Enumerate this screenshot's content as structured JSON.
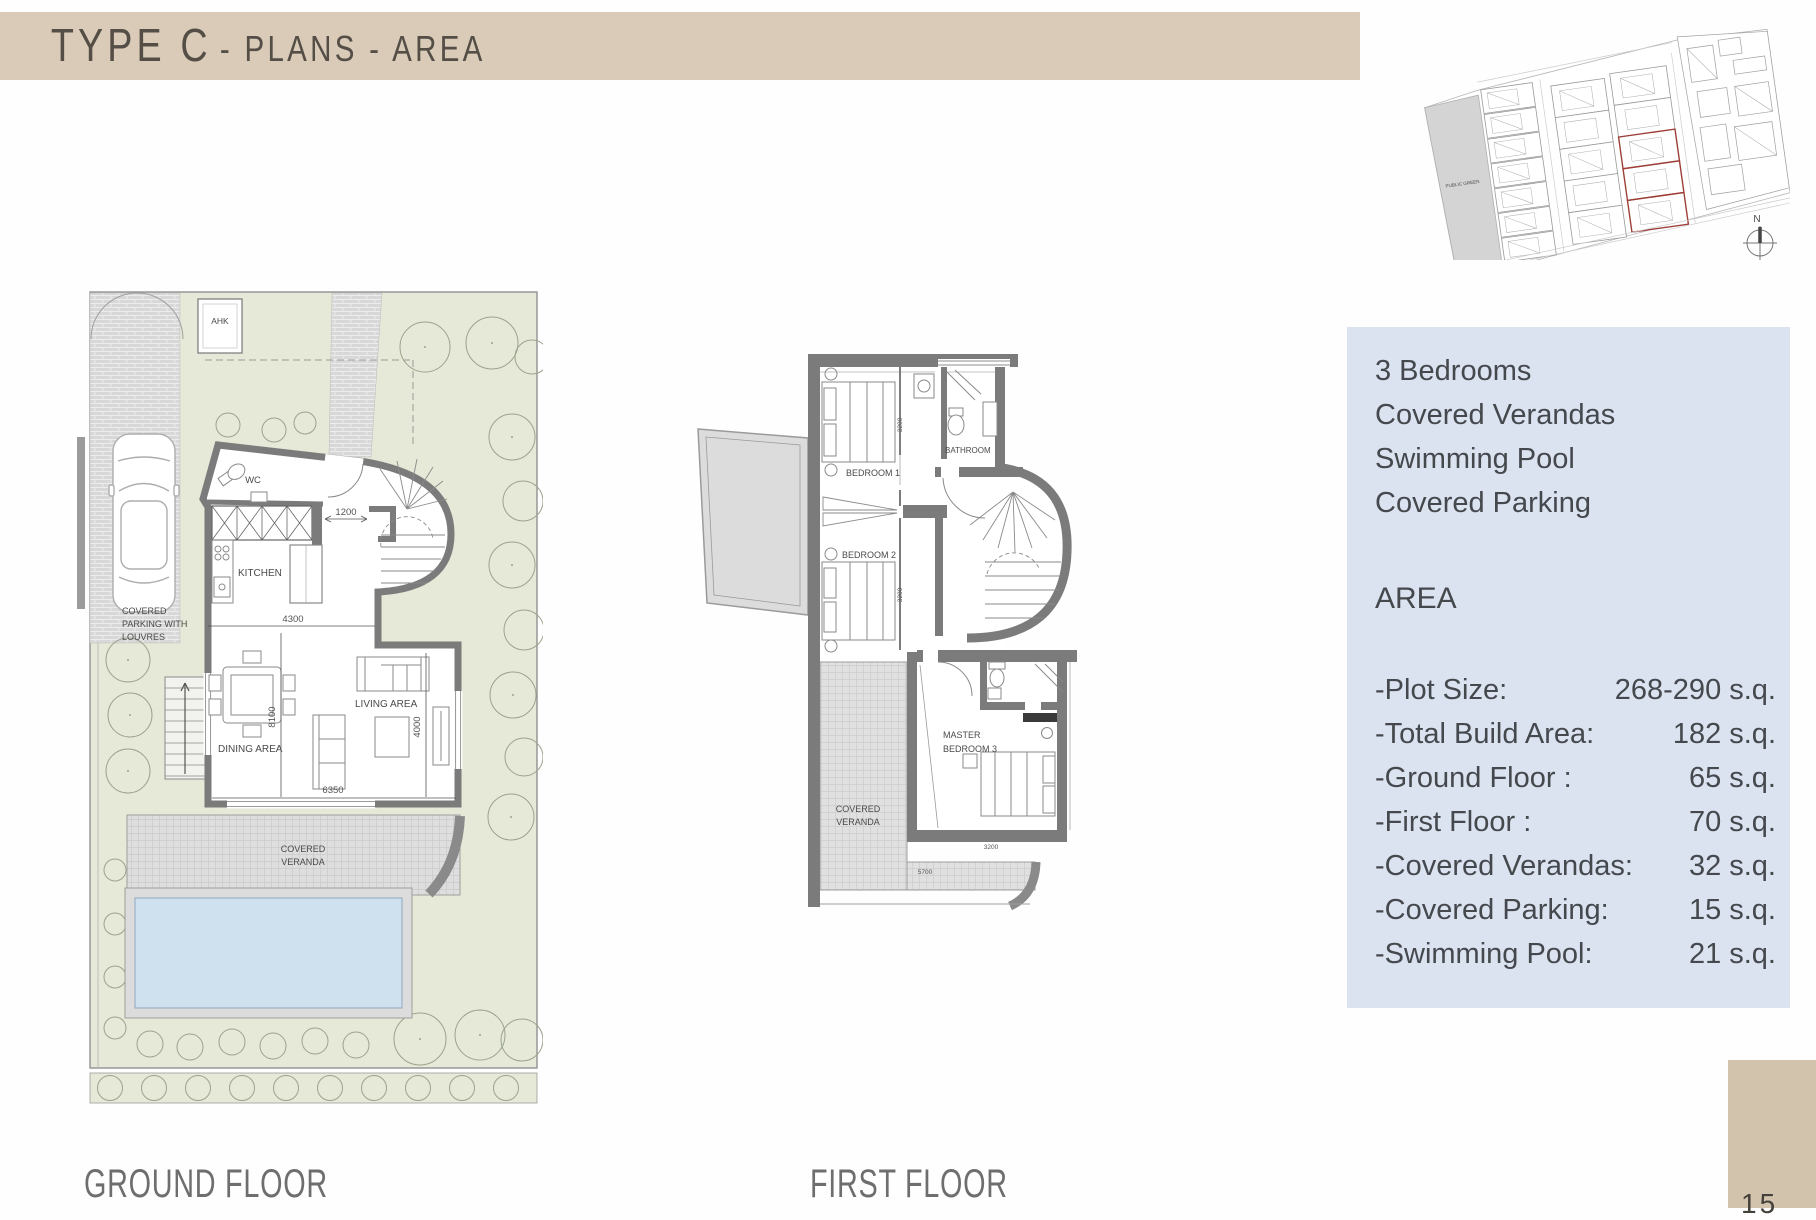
{
  "title": {
    "main": "TYPE C",
    "sub": "- PLANS - AREA"
  },
  "page_number": "15",
  "captions": {
    "ground_floor": "GROUND FLOOR",
    "first_floor": "FIRST FLOOR"
  },
  "site_plan": {
    "public_green": "PUBLIC GREEN",
    "north": "N"
  },
  "ground_floor_plan": {
    "ahk": "AHK",
    "rooms": {
      "wc": "WC",
      "kitchen": "KITCHEN",
      "dining": "DINING AREA",
      "living": "LIVING AREA"
    },
    "veranda": [
      "COVERED",
      "VERANDA"
    ],
    "parking": [
      "COVERED",
      "PARKING WITH",
      "LOUVRES"
    ],
    "dims": {
      "entrance": "1200",
      "kitchen_width": "4300",
      "depth": "8100",
      "living_depth": "4000",
      "width": "6350"
    }
  },
  "first_floor_plan": {
    "rooms": {
      "bedroom1": "BEDROOM 1",
      "bedroom2": "BEDROOM 2",
      "bathroom": "BATHROOM"
    },
    "master": [
      "MASTER",
      "BEDROOM 3"
    ],
    "veranda": [
      "COVERED",
      "VERANDA"
    ],
    "dims": {
      "bed1": "3200",
      "bed2": "3200",
      "master": "3200",
      "veranda_width": "5700"
    }
  },
  "info_box": {
    "features": [
      "3 Bedrooms",
      "Covered Verandas",
      "Swimming Pool",
      "Covered Parking"
    ],
    "area_heading": "AREA",
    "rows": [
      {
        "label": "-Plot Size:",
        "value": "268-290 s.q."
      },
      {
        "label": "-Total Build Area:",
        "value": "182 s.q."
      },
      {
        "label": "-Ground Floor :",
        "value": "65 s.q."
      },
      {
        "label": "-First Floor :",
        "value": "70 s.q."
      },
      {
        "label": "-Covered Verandas:",
        "value": "32 s.q."
      },
      {
        "label": "-Covered Parking:",
        "value": "15 s.q."
      },
      {
        "label": "-Swimming Pool:",
        "value": "21 s.q."
      }
    ]
  },
  "colors": {
    "title_bar": "#d9cbb8",
    "info_box": "#dbe3f1",
    "accent_tan": "#d2c3ad",
    "garden": "#e6e9d7",
    "pool": "#cfe0ef",
    "wall": "#7b7b7b",
    "red_outline": "#9e4038"
  }
}
